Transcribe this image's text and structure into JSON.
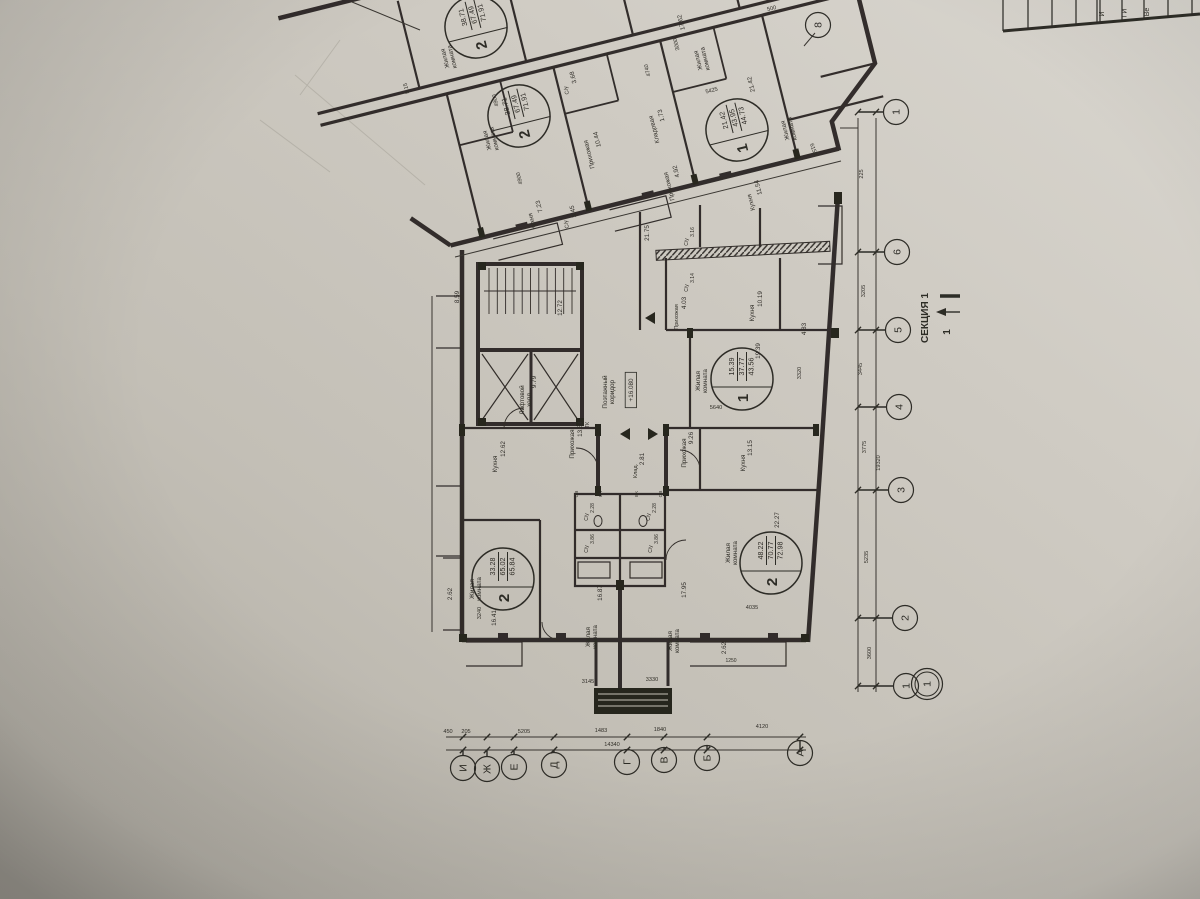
{
  "sheet": {
    "section_label": "СЕКЦИЯ 1",
    "section_cut_number": "1",
    "level_mark": "+16.080",
    "title_block_row_labels": [
      "И",
      "ГИ",
      "Ве"
    ],
    "paper_color": "#c9c5bc",
    "ink_color": "#221f1a"
  },
  "apartments": [
    {
      "rooms": "2",
      "living": "38.71",
      "total": "67.49",
      "total_with_balcony": "71.91",
      "x": 476,
      "y": 27,
      "r": -104
    },
    {
      "rooms": "2",
      "living": "38.71",
      "total": "67.49",
      "total_with_balcony": "71.91",
      "x": 519,
      "y": 116,
      "r": -104
    },
    {
      "rooms": "1",
      "living": "21.42",
      "total": "43.95",
      "total_with_balcony": "44.73",
      "x": 737,
      "y": 130,
      "r": -104
    },
    {
      "rooms": "1",
      "living": "15.39",
      "total": "37.77",
      "total_with_balcony": "43.56",
      "x": 742,
      "y": 379,
      "r": -90
    },
    {
      "rooms": "2",
      "living": "33.28",
      "total": "65.02",
      "total_with_balcony": "65.84",
      "x": 503,
      "y": 579,
      "r": -90
    },
    {
      "rooms": "2",
      "living": "48.22",
      "total": "70.77",
      "total_with_balcony": "72.98",
      "x": 771,
      "y": 563,
      "r": -90
    }
  ],
  "axis_bubbles": {
    "right": [
      {
        "n": "8",
        "x": 818,
        "y": 25
      },
      {
        "n": "1",
        "x": 896,
        "y": 112
      },
      {
        "n": "6",
        "x": 897,
        "y": 252
      },
      {
        "n": "5",
        "x": 898,
        "y": 330
      },
      {
        "n": "4",
        "x": 899,
        "y": 407
      },
      {
        "n": "3",
        "x": 901,
        "y": 490
      },
      {
        "n": "2",
        "x": 905,
        "y": 618
      },
      {
        "n": "1",
        "x": 906,
        "y": 686
      },
      {
        "n": "1",
        "x": 927,
        "y": 684,
        "double": true
      }
    ],
    "bottom": [
      {
        "n": "И",
        "x": 463,
        "y": 768
      },
      {
        "n": "Ж",
        "x": 487,
        "y": 769
      },
      {
        "n": "Е",
        "x": 514,
        "y": 767
      },
      {
        "n": "Д",
        "x": 554,
        "y": 765
      },
      {
        "n": "Г",
        "x": 627,
        "y": 762
      },
      {
        "n": "В",
        "x": 664,
        "y": 760
      },
      {
        "n": "Б",
        "x": 707,
        "y": 758
      },
      {
        "n": "А",
        "x": 800,
        "y": 753
      }
    ]
  },
  "room_labels": [
    {
      "t": "Жилая",
      "t2": "комната",
      "x": 447,
      "y": 58,
      "r": -104
    },
    {
      "t": "Жилая",
      "t2": "комната",
      "x": 489,
      "y": 140,
      "r": -104
    },
    {
      "t": "Жилая",
      "t2": "комната",
      "x": 700,
      "y": 60,
      "r": -104
    },
    {
      "t": "17.62",
      "x": 683,
      "y": 22,
      "r": -104
    },
    {
      "t": "Жилая",
      "t2": "комната",
      "x": 787,
      "y": 130,
      "r": -104
    },
    {
      "t": "21.42",
      "x": 753,
      "y": 84,
      "r": -104
    },
    {
      "t": "Кухня",
      "x": 534,
      "y": 221,
      "r": -104
    },
    {
      "t": "7.23",
      "x": 541,
      "y": 206,
      "r": -104
    },
    {
      "t": "С/у",
      "x": 568,
      "y": 224,
      "r": -104,
      "s": 5.5
    },
    {
      "t": "3.45",
      "x": 575,
      "y": 211,
      "r": -104
    },
    {
      "t": "С/у",
      "x": 568,
      "y": 90,
      "r": -104,
      "s": 5.5
    },
    {
      "t": "3.68",
      "x": 575,
      "y": 77,
      "r": -104
    },
    {
      "t": "Прихожая",
      "x": 591,
      "y": 154,
      "r": -104
    },
    {
      "t": "10.44",
      "x": 599,
      "y": 139,
      "r": -104
    },
    {
      "t": "Кладовая",
      "x": 656,
      "y": 129,
      "r": -104
    },
    {
      "t": "1.73",
      "x": 663,
      "y": 115,
      "r": -104
    },
    {
      "t": "Прихожая",
      "x": 671,
      "y": 186,
      "r": -104
    },
    {
      "t": "4.92",
      "x": 678,
      "y": 171,
      "r": -104
    },
    {
      "t": "Кухня",
      "x": 753,
      "y": 202,
      "r": -104
    },
    {
      "t": "11.54",
      "x": 760,
      "y": 187,
      "r": -104
    },
    {
      "t": "Лифтовой",
      "t2": "холл",
      "x": 524,
      "y": 400
    },
    {
      "t": "9.79",
      "x": 536,
      "y": 382
    },
    {
      "t": "12.72",
      "x": 562,
      "y": 308
    },
    {
      "t": "8.59",
      "x": 459,
      "y": 297
    },
    {
      "t": "Поэтажный",
      "t2": "коридор",
      "x": 607,
      "y": 392
    },
    {
      "t": "+16.080",
      "x": 633,
      "y": 390,
      "box": true
    },
    {
      "t": "ТК",
      "x": 589,
      "y": 425,
      "s": 5
    },
    {
      "t": "Прихожая",
      "x": 574,
      "y": 444
    },
    {
      "t": "13.84",
      "x": 582,
      "y": 429
    },
    {
      "t": "Кухня",
      "x": 497,
      "y": 464
    },
    {
      "t": "12.62",
      "x": 505,
      "y": 449
    },
    {
      "t": "Клад.",
      "x": 637,
      "y": 471,
      "s": 5.5
    },
    {
      "t": "2.81",
      "x": 644,
      "y": 459
    },
    {
      "t": "Прихожая",
      "x": 686,
      "y": 453
    },
    {
      "t": "9.26",
      "x": 693,
      "y": 438
    },
    {
      "t": "Кухня",
      "x": 745,
      "y": 463
    },
    {
      "t": "13.15",
      "x": 752,
      "y": 448
    },
    {
      "t": "Кухня",
      "x": 754,
      "y": 313
    },
    {
      "t": "10.19",
      "x": 762,
      "y": 299
    },
    {
      "t": "Прихожая",
      "x": 678,
      "y": 317,
      "s": 5.5
    },
    {
      "t": "4.03",
      "x": 686,
      "y": 303
    },
    {
      "t": "С/у",
      "x": 588,
      "y": 517,
      "s": 5
    },
    {
      "t": "2.28",
      "x": 594,
      "y": 508,
      "s": 5
    },
    {
      "t": "С/у",
      "x": 650,
      "y": 517,
      "s": 5
    },
    {
      "t": "2.28",
      "x": 656,
      "y": 508,
      "s": 5
    },
    {
      "t": "С/у",
      "x": 588,
      "y": 549,
      "s": 5
    },
    {
      "t": "3.86",
      "x": 594,
      "y": 539,
      "s": 5
    },
    {
      "t": "С/у",
      "x": 652,
      "y": 549,
      "s": 5
    },
    {
      "t": "3.86",
      "x": 658,
      "y": 539,
      "s": 5
    },
    {
      "t": "ОВ",
      "x": 578,
      "y": 494,
      "s": 4.6
    },
    {
      "t": "ВК",
      "x": 602,
      "y": 494,
      "s": 4.6
    },
    {
      "t": "ВК",
      "x": 638,
      "y": 494,
      "s": 4.6
    },
    {
      "t": "ОВ",
      "x": 662,
      "y": 494,
      "s": 4.6
    },
    {
      "t": "С/у",
      "x": 688,
      "y": 242,
      "s": 5
    },
    {
      "t": "3.16",
      "x": 694,
      "y": 232,
      "s": 5
    },
    {
      "t": "С/у",
      "x": 688,
      "y": 288,
      "s": 5
    },
    {
      "t": "3.14",
      "x": 694,
      "y": 278,
      "s": 5
    },
    {
      "t": "21.75",
      "x": 649,
      "y": 233
    },
    {
      "t": "4.83",
      "x": 806,
      "y": 329
    },
    {
      "t": "Жилая",
      "t2": "комната",
      "x": 474,
      "y": 589
    },
    {
      "t": "16.41",
      "x": 496,
      "y": 618
    },
    {
      "t": "Жилая",
      "t2": "комната",
      "x": 590,
      "y": 637
    },
    {
      "t": "16.87",
      "x": 602,
      "y": 593
    },
    {
      "t": "Жилая",
      "t2": "комната",
      "x": 672,
      "y": 641
    },
    {
      "t": "17.95",
      "x": 686,
      "y": 590
    },
    {
      "t": "Жилая",
      "t2": "комната",
      "x": 730,
      "y": 553
    },
    {
      "t": "22.27",
      "x": 779,
      "y": 520
    },
    {
      "t": "Жилая",
      "t2": "комната",
      "x": 700,
      "y": 381
    },
    {
      "t": "19.39",
      "x": 760,
      "y": 351
    },
    {
      "t": "2.62",
      "x": 452,
      "y": 594
    },
    {
      "t": "2.62",
      "x": 726,
      "y": 648
    }
  ],
  "dim_labels": [
    {
      "t": "4900",
      "x": 497,
      "y": 100,
      "r": -104
    },
    {
      "t": "4900",
      "x": 521,
      "y": 178,
      "r": -104
    },
    {
      "t": "3000",
      "x": 678,
      "y": 44,
      "r": -104
    },
    {
      "t": "4740",
      "x": 649,
      "y": 70,
      "r": -104
    },
    {
      "t": "5.15",
      "x": 408,
      "y": 88,
      "r": -104
    },
    {
      "t": "500",
      "x": 772,
      "y": 10,
      "r": -14
    },
    {
      "t": "5425",
      "x": 712,
      "y": 92,
      "r": -14
    },
    {
      "t": "6150",
      "x": 812,
      "y": 150,
      "r": 70
    },
    {
      "t": "5640",
      "x": 716,
      "y": 409,
      "r": 0
    },
    {
      "t": "3320",
      "x": 801,
      "y": 373
    },
    {
      "t": "4035",
      "x": 752,
      "y": 609,
      "r": 0
    },
    {
      "t": "3145",
      "x": 588,
      "y": 683,
      "r": 0
    },
    {
      "t": "3330",
      "x": 652,
      "y": 681,
      "r": 0
    },
    {
      "t": "1250",
      "x": 731,
      "y": 662,
      "r": 0,
      "s": 5
    },
    {
      "t": "3240",
      "x": 481,
      "y": 613
    },
    {
      "t": "225",
      "x": 863,
      "y": 174
    },
    {
      "t": "3205",
      "x": 865,
      "y": 291
    },
    {
      "t": "3445",
      "x": 862,
      "y": 369
    },
    {
      "t": "3775",
      "x": 866,
      "y": 447
    },
    {
      "t": "19320",
      "x": 880,
      "y": 463
    },
    {
      "t": "5235",
      "x": 868,
      "y": 557
    },
    {
      "t": "3600",
      "x": 871,
      "y": 653
    },
    {
      "t": "205",
      "x": 466,
      "y": 733,
      "r": 0
    },
    {
      "t": "450",
      "x": 448,
      "y": 733,
      "r": 0
    },
    {
      "t": "5205",
      "x": 524,
      "y": 733,
      "r": 0
    },
    {
      "t": "1483",
      "x": 601,
      "y": 732,
      "r": 0
    },
    {
      "t": "1840",
      "x": 660,
      "y": 731,
      "r": 0
    },
    {
      "t": "4120",
      "x": 762,
      "y": 728,
      "r": 0
    },
    {
      "t": "14340",
      "x": 612,
      "y": 746,
      "r": 0
    }
  ]
}
